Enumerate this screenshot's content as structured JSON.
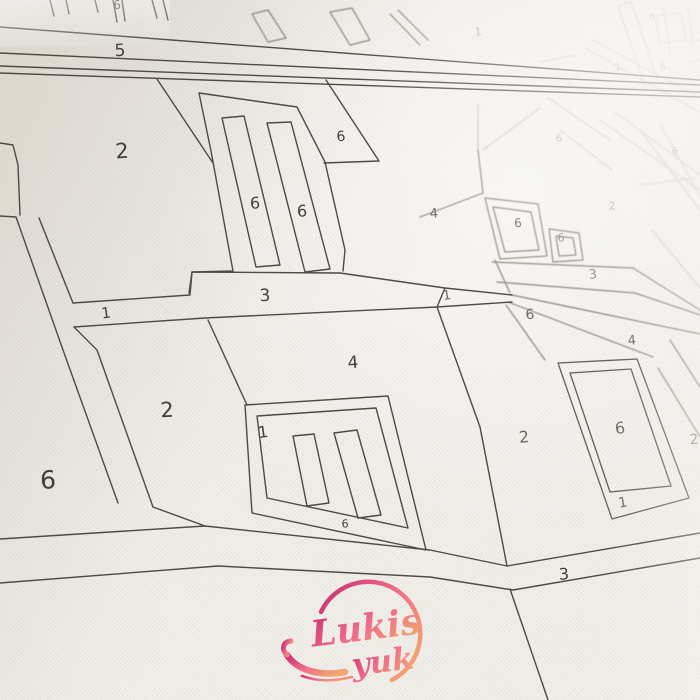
{
  "artwork": {
    "type": "paint-by-number canvas photo",
    "brand": {
      "line1": "Lukis",
      "line2": "yuk"
    },
    "brand_colors": {
      "pink": "#c9256b",
      "rose": "#ef5f82",
      "orange": "#f4a268"
    },
    "canvas_color": "#f2f0eb",
    "line_color_foreground": "#4f4a43",
    "line_color_background": "#c9c5be",
    "region_numbers": [
      {
        "v": "6",
        "x": 117,
        "y": 5,
        "s": 12,
        "t": "fg",
        "r": -4
      },
      {
        "v": "5",
        "x": 120,
        "y": 51,
        "s": 17,
        "t": "fg",
        "r": -4
      },
      {
        "v": "2",
        "x": 122,
        "y": 151,
        "s": 21,
        "t": "fg",
        "r": -4
      },
      {
        "v": "6",
        "x": 341,
        "y": 137,
        "s": 14,
        "t": "fg",
        "r": -5
      },
      {
        "v": "6",
        "x": 255,
        "y": 203,
        "s": 16,
        "t": "fg",
        "r": -3
      },
      {
        "v": "6",
        "x": 302,
        "y": 211,
        "s": 16,
        "t": "fg",
        "r": -3
      },
      {
        "v": "3",
        "x": 265,
        "y": 296,
        "s": 17,
        "t": "fg",
        "r": -3
      },
      {
        "v": "1",
        "x": 106,
        "y": 313,
        "s": 15,
        "t": "fg",
        "r": -8
      },
      {
        "v": "4",
        "x": 353,
        "y": 363,
        "s": 17,
        "t": "fg",
        "r": -4
      },
      {
        "v": "2",
        "x": 167,
        "y": 410,
        "s": 21,
        "t": "fg",
        "r": -3
      },
      {
        "v": "1",
        "x": 263,
        "y": 432,
        "s": 16,
        "t": "fg",
        "r": -8
      },
      {
        "v": "6",
        "x": 345,
        "y": 524,
        "s": 11,
        "t": "fg",
        "r": -3
      },
      {
        "v": "6",
        "x": 48,
        "y": 480,
        "s": 25,
        "t": "fg",
        "r": -2
      },
      {
        "v": "2",
        "x": 524,
        "y": 437,
        "s": 16,
        "t": "mid",
        "r": -5
      },
      {
        "v": "3",
        "x": 564,
        "y": 574,
        "s": 16,
        "t": "fg",
        "r": -4
      },
      {
        "v": "6",
        "x": 620,
        "y": 428,
        "s": 16,
        "t": "mid",
        "r": -6
      },
      {
        "v": "1",
        "x": 623,
        "y": 503,
        "s": 14,
        "t": "mid",
        "r": -10
      },
      {
        "v": "2",
        "x": 694,
        "y": 440,
        "s": 14,
        "t": "soft",
        "r": -5
      },
      {
        "v": "4",
        "x": 632,
        "y": 341,
        "s": 13,
        "t": "mid",
        "r": -5
      },
      {
        "v": "1",
        "x": 447,
        "y": 296,
        "s": 13,
        "t": "mid",
        "r": -8
      },
      {
        "v": "6",
        "x": 530,
        "y": 315,
        "s": 14,
        "t": "mid",
        "r": -5
      },
      {
        "v": "3",
        "x": 593,
        "y": 275,
        "s": 13,
        "t": "soft",
        "r": -5
      },
      {
        "v": "4",
        "x": 434,
        "y": 214,
        "s": 13,
        "t": "mid",
        "r": -5
      },
      {
        "v": "6",
        "x": 518,
        "y": 223,
        "s": 12,
        "t": "mid",
        "r": -5
      },
      {
        "v": "6",
        "x": 561,
        "y": 238,
        "s": 11,
        "t": "soft",
        "r": -5
      },
      {
        "v": "1",
        "x": 478,
        "y": 32,
        "s": 11,
        "t": "bg",
        "r": -5
      },
      {
        "v": "1",
        "x": 618,
        "y": 68,
        "s": 10,
        "t": "bg",
        "r": -5
      },
      {
        "v": "6",
        "x": 663,
        "y": 67,
        "s": 10,
        "t": "bg",
        "r": -5
      },
      {
        "v": "6",
        "x": 559,
        "y": 139,
        "s": 10,
        "t": "bg",
        "r": -5
      },
      {
        "v": "6",
        "x": 675,
        "y": 152,
        "s": 10,
        "t": "bg",
        "r": -5
      },
      {
        "v": "2",
        "x": 612,
        "y": 206,
        "s": 11,
        "t": "bg",
        "r": -5
      },
      {
        "v": "6",
        "x": 652,
        "y": 17,
        "s": 9,
        "t": "bg",
        "r": -5
      }
    ]
  }
}
